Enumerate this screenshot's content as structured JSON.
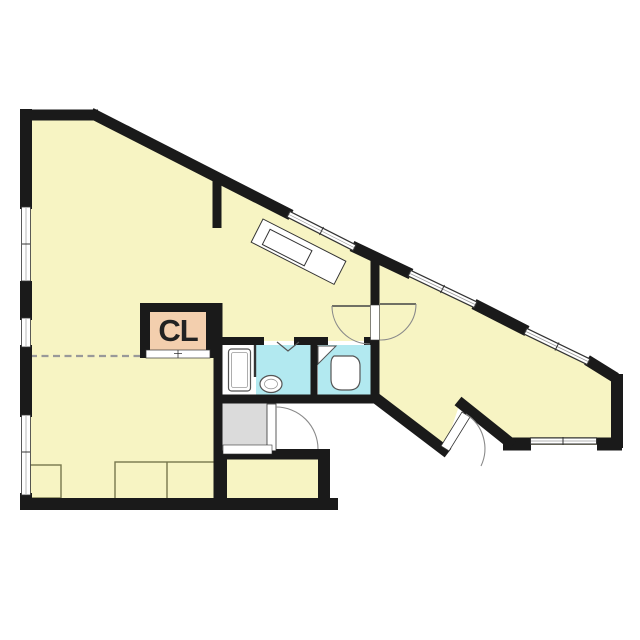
{
  "labels": {
    "closet": "CL"
  },
  "colors": {
    "background": "#ffffff",
    "floor_yellow": "#f7f4c3",
    "closet_peach": "#f3cfae",
    "bath_cyan": "#b2e9f0",
    "entry_gray": "#dbdbdb",
    "wall_black": "#1a1a1a",
    "fixture_outline": "#555555",
    "counter_outline": "#77774d",
    "dashed_line": "#999999"
  }
}
